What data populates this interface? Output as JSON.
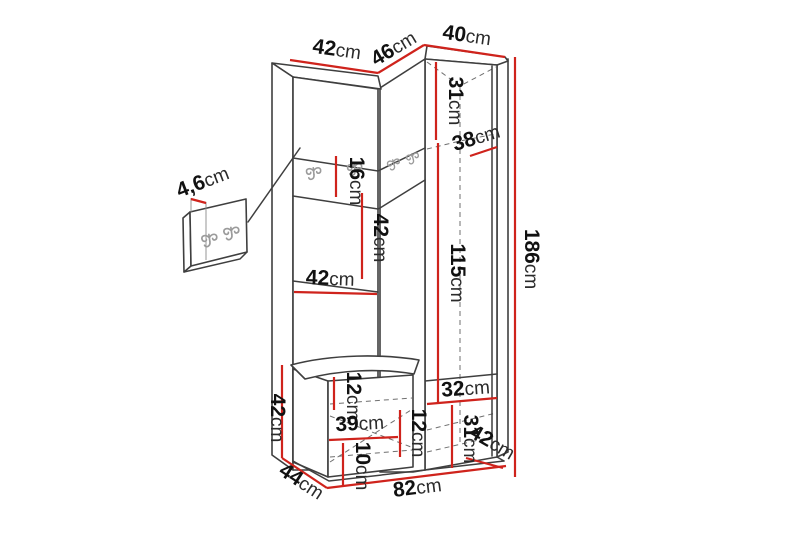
{
  "diagram": {
    "title": "hallway-wardrobe-dimension-diagram",
    "unit_system": "cm",
    "colors": {
      "dimension_line": "#cf231c",
      "outline": "#3f3f3f",
      "dashed_interior": "#6f6f6f",
      "label_text": "#151515",
      "hook_icon": "#9b9b9b",
      "background": "#ffffff"
    },
    "icons": {
      "hook": "double-coat-hook-icon"
    },
    "dimensions": {
      "top_width_left": {
        "num": "42",
        "unit": "cm"
      },
      "top_width_angled": {
        "num": "46",
        "unit": "cm"
      },
      "top_width_corner": {
        "num": "40",
        "unit": "cm"
      },
      "corner_top_height": {
        "num": "31",
        "unit": "cm"
      },
      "corner_shelf_depth": {
        "num": "38",
        "unit": "cm"
      },
      "hook_panel_thickness": {
        "num": "4,6",
        "unit": "cm"
      },
      "hook_band_height": {
        "num": "16",
        "unit": "cm"
      },
      "open_section_height": {
        "num": "42",
        "unit": "cm"
      },
      "shelf_width": {
        "num": "42",
        "unit": "cm"
      },
      "corner_inner_height": {
        "num": "115",
        "unit": "cm"
      },
      "total_height": {
        "num": "186",
        "unit": "cm"
      },
      "bench_height": {
        "num": "42",
        "unit": "cm"
      },
      "seat_thickness": {
        "num": "12",
        "unit": "cm"
      },
      "bench_inner_width": {
        "num": "39",
        "unit": "cm"
      },
      "bench_inner_height": {
        "num": "12",
        "unit": "cm"
      },
      "plinth_height": {
        "num": "10",
        "unit": "cm"
      },
      "bench_depth": {
        "num": "44",
        "unit": "cm"
      },
      "total_width": {
        "num": "82",
        "unit": "cm"
      },
      "corner_bottom_width": {
        "num": "32",
        "unit": "cm"
      },
      "corner_bottom_height": {
        "num": "31",
        "unit": "cm"
      },
      "corner_bottom_depth": {
        "num": "42",
        "unit": "cm"
      }
    }
  }
}
